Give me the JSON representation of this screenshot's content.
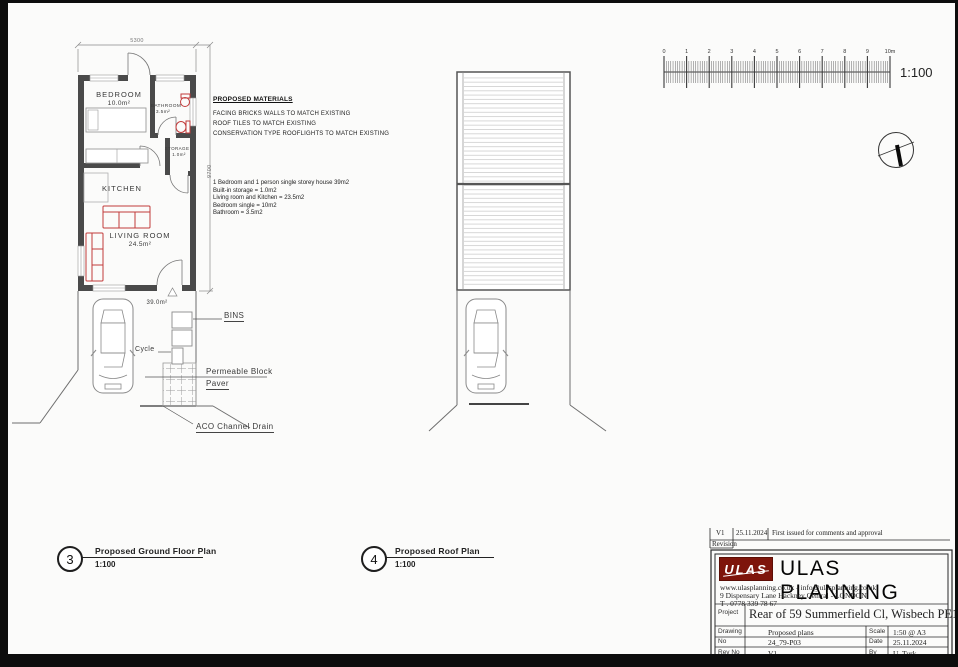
{
  "ground_floor": {
    "caption_number": "3",
    "caption_title": "Proposed Ground Floor Plan",
    "caption_scale": "1:100",
    "dim_width": "5300",
    "dim_height": "9700",
    "rooms": {
      "bedroom_name": "BEDROOM",
      "bedroom_area": "10.0m²",
      "bathroom_name": "BATHROOM",
      "bathroom_area": "3.5m²",
      "storage_name": "STORAGE",
      "storage_area": "1.0m²",
      "kitchen_name": "KITCHEN",
      "living_name": "LIVING ROOM",
      "living_area": "24.5m²"
    },
    "garden_area": "39.0m²",
    "labels": {
      "bins": "BINS",
      "cycle": "Cycle",
      "paver_line1": "Permeable Block",
      "paver_line2": "Paver",
      "drain": "ACO Channel Drain"
    }
  },
  "roof": {
    "caption_number": "4",
    "caption_title": "Proposed Roof Plan",
    "caption_scale": "1:100"
  },
  "materials": {
    "title": "PROPOSED MATERIALS",
    "items": [
      "FACING BRICKS WALLS TO MATCH EXISTING",
      "ROOF TILES TO MATCH EXISTING",
      "CONSERVATION TYPE ROOFLIGHTS TO MATCH EXISTING"
    ]
  },
  "schedule": {
    "lines": [
      "1 Bedroom and 1 person single storey house 39m2",
      "Built-in storage =  1.0m2",
      "Living room and Kitchen =  23.5m2",
      "Bedroom single = 10m2",
      "Bathroom = 3.5m2"
    ]
  },
  "scale_bar": {
    "ticks": [
      "0",
      "1",
      "2",
      "3",
      "4",
      "5",
      "6",
      "7",
      "8",
      "9",
      "10m"
    ],
    "ratio_label": "1:100"
  },
  "title_block": {
    "revision": {
      "rev": "V1",
      "date": "25.11.2024",
      "note": "First issued for comments and approval",
      "row_label": "Revision"
    },
    "logo_text": "ULAS",
    "company_name": "ULAS PLANNING",
    "contact_line1": "www.ulasplanning.co.uk   -   info@ulasplanning.co.uk",
    "contact_line2": "9 Dispensary Lane Hackney Central - LONDON",
    "contact_line3": "T . 0778 339 78 67",
    "project_label": "Project",
    "project_value": "Rear of 59 Summerfield Cl, Wisbech PE13 1RP",
    "drawing_label": "Drawing",
    "drawing_value": "Proposed plans",
    "scale_label": "Scale",
    "scale_value": "1:50 @ A3",
    "no_label": "No",
    "no_value": "24_79-P03",
    "date_label": "Date",
    "date_value": "25.11.2024",
    "revno_label": "Rev No",
    "revno_value": "V1",
    "by_label": "By",
    "by_value": "U. Turk"
  },
  "colors": {
    "wall": "#4a4a4a",
    "furniture_red": "#c23b3b",
    "logo_red": "#7e150b",
    "line": "#555555"
  }
}
